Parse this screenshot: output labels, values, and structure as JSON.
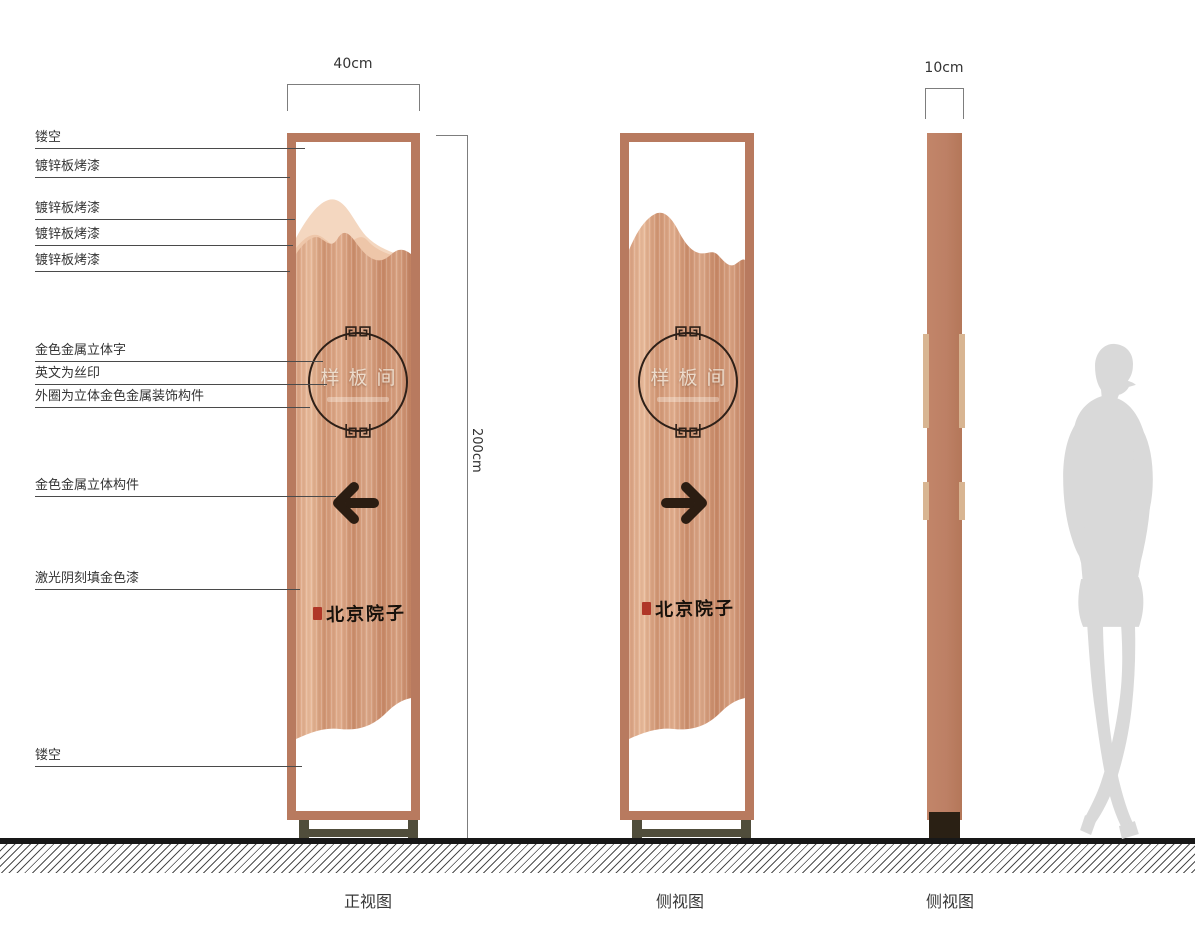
{
  "callouts": [
    {
      "label": "镂空"
    },
    {
      "label": "镀锌板烤漆"
    },
    {
      "label": "镀锌板烤漆"
    },
    {
      "label": "镀锌板烤漆"
    },
    {
      "label": "镀锌板烤漆"
    },
    {
      "label": "金色金属立体字"
    },
    {
      "label": "英文为丝印"
    },
    {
      "label": "外圈为立体金色金属装饰构件"
    },
    {
      "label": "金色金属立体构件"
    },
    {
      "label": "激光阴刻填金色漆"
    },
    {
      "label": "镂空"
    }
  ],
  "dimensions": {
    "width_label": "40cm",
    "height_label": "200cm",
    "depth_label": "10cm"
  },
  "captions": {
    "front_view": "正视图",
    "side_view_1": "侧视图",
    "side_view_2": "侧视图"
  },
  "sign": {
    "plaque_text": "样板间",
    "brand_text": "北京院子"
  },
  "colors": {
    "frame_copper": "#b87a5f",
    "panel_copper": "#d49a79",
    "mountain_light": "#f4d7c0",
    "mountain_mid": "#eec6a9",
    "side_bar": "#bd8065",
    "tab_light": "#d8b592",
    "base_olive": "#504d3b",
    "base_dark": "#2a2014",
    "arrow_dark": "#2b1d12",
    "seal_red": "#b03728",
    "silhouette_gray": "#d9d9d9"
  }
}
